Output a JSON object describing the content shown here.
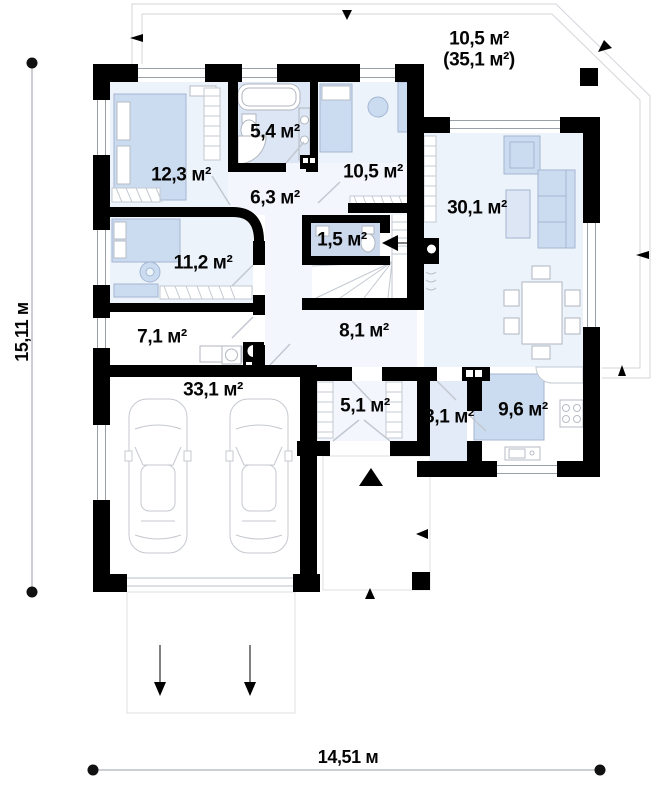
{
  "plan": {
    "rooms": {
      "terrace": {
        "area": "10,5 м²",
        "area_total": "(35,1 м²)"
      },
      "bedroom_1": {
        "area": "12,3 м²"
      },
      "bathroom": {
        "area": "5,4 м²"
      },
      "office": {
        "area": "10,5 м²"
      },
      "living_room": {
        "area": "30,1 м²"
      },
      "hall": {
        "area": "6,3 м²"
      },
      "wc": {
        "area": "1,5 м²"
      },
      "bedroom_2": {
        "area": "11,2 м²"
      },
      "utility": {
        "area": "7,1 м²"
      },
      "corridor": {
        "area": "8,1 м²"
      },
      "garage": {
        "area": "33,1 м²"
      },
      "entry": {
        "area": "5,1 м²"
      },
      "pantry": {
        "area": "3,1 м²"
      },
      "kitchen": {
        "area": "9,6 м²"
      }
    },
    "dimensions": {
      "side": "15,11 м",
      "bottom": "14,51 м"
    },
    "colors": {
      "wall": "#000000",
      "room_fill": "#edf3fb",
      "furniture_fill": "#ccdcf0",
      "bath_fill": "#dce6f4",
      "wc_fill": "#ccd9ec",
      "outline": "#d2d5da"
    }
  }
}
